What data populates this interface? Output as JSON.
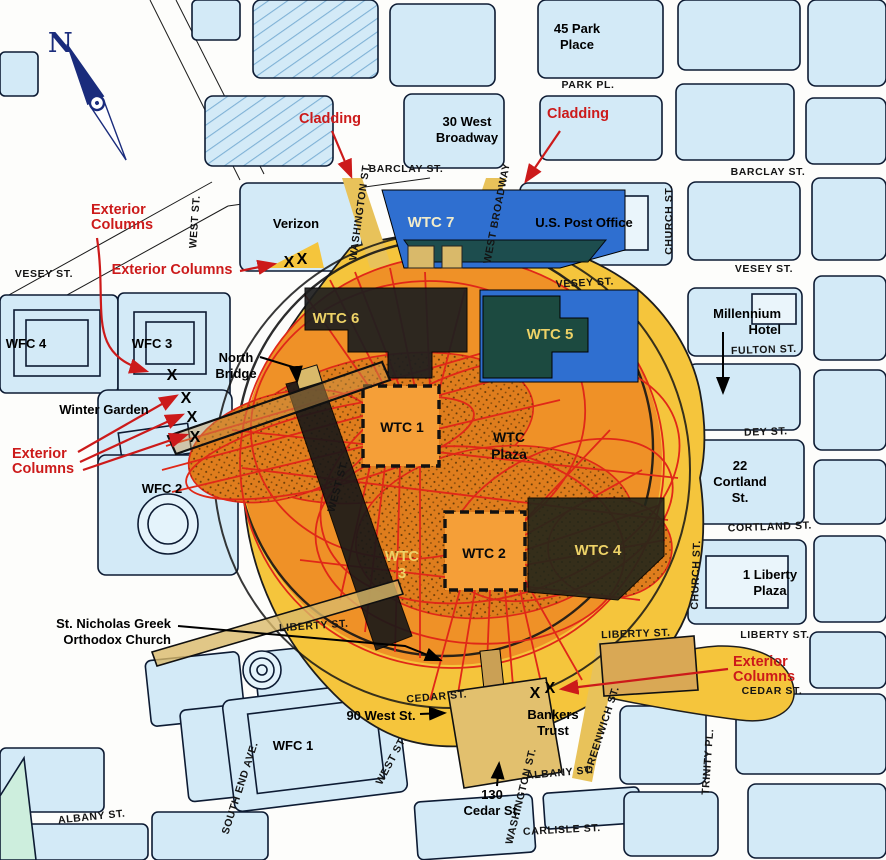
{
  "map": {
    "compass_label": "N",
    "colors": {
      "debris_outer_yellow": "#F5C53C",
      "debris_inner_orange": "#EF9127",
      "debris_dense_orange": "#DF7D1D",
      "impact_line_red": "#E02818",
      "annotation_red": "#CC1A1A",
      "block_fill": "#D3EAF7",
      "block_outline": "#0D1B33",
      "wtc7_blue": "#2F6FD0",
      "wtc5_teal": "#1C4A40",
      "dark_mass": "#1B1B1B",
      "bridge_khaki": "#D9B96A",
      "wtc_label_yellow": "#EDD267",
      "compass_navy": "#1A2C7C"
    },
    "streets": [
      {
        "t": "PARK PL.",
        "x": 588,
        "y": 88,
        "r": 0
      },
      {
        "t": "BARCLAY ST.",
        "x": 406,
        "y": 172,
        "r": 0
      },
      {
        "t": "BARCLAY ST.",
        "x": 768,
        "y": 175,
        "r": 0
      },
      {
        "t": "VESEY ST.",
        "x": 44,
        "y": 277,
        "r": 0
      },
      {
        "t": "VESEY ST.",
        "x": 585,
        "y": 286,
        "r": -3
      },
      {
        "t": "VESEY ST.",
        "x": 764,
        "y": 272,
        "r": 0
      },
      {
        "t": "FULTON ST.",
        "x": 764,
        "y": 353,
        "r": -2
      },
      {
        "t": "DEY ST.",
        "x": 766,
        "y": 435,
        "r": -2
      },
      {
        "t": "CORTLAND ST.",
        "x": 770,
        "y": 530,
        "r": -2
      },
      {
        "t": "LIBERTY ST.",
        "x": 314,
        "y": 629,
        "r": -4
      },
      {
        "t": "LIBERTY ST.",
        "x": 636,
        "y": 637,
        "r": -2
      },
      {
        "t": "LIBERTY ST.",
        "x": 775,
        "y": 638,
        "r": 0
      },
      {
        "t": "CEDAR ST.",
        "x": 437,
        "y": 700,
        "r": -5
      },
      {
        "t": "CEDAR ST.",
        "x": 772,
        "y": 694,
        "r": 0
      },
      {
        "t": "ALBANY ST.",
        "x": 92,
        "y": 820,
        "r": -6
      },
      {
        "t": "ALBANY ST.",
        "x": 560,
        "y": 776,
        "r": -5
      },
      {
        "t": "CARLISLE ST.",
        "x": 562,
        "y": 833,
        "r": -3
      },
      {
        "t": "WEST ST.",
        "x": 198,
        "y": 222,
        "r": -86
      },
      {
        "t": "WEST ST.",
        "x": 341,
        "y": 487,
        "r": -75
      },
      {
        "t": "WEST ST.",
        "x": 394,
        "y": 762,
        "r": -62
      },
      {
        "t": "WASHINGTON ST.",
        "x": 363,
        "y": 212,
        "r": -82
      },
      {
        "t": "WASHINGTON ST.",
        "x": 524,
        "y": 797,
        "r": -76
      },
      {
        "t": "WEST BROADWAY",
        "x": 500,
        "y": 214,
        "r": -79
      },
      {
        "t": "CHURCH ST.",
        "x": 672,
        "y": 220,
        "r": -90
      },
      {
        "t": "CHURCH ST.",
        "x": 699,
        "y": 575,
        "r": -88
      },
      {
        "t": "GREENWICH ST.",
        "x": 605,
        "y": 731,
        "r": -72
      },
      {
        "t": "TRINITY PL.",
        "x": 711,
        "y": 762,
        "r": -86
      },
      {
        "t": "SOUTH END AVE.",
        "x": 243,
        "y": 789,
        "r": -72
      }
    ],
    "buildings": [
      {
        "lines": [
          "45 Park",
          "Place"
        ],
        "x": 577,
        "y": 33,
        "anchor": "middle"
      },
      {
        "lines": [
          "30 West",
          "Broadway"
        ],
        "x": 467,
        "y": 126,
        "anchor": "middle"
      },
      {
        "lines": [
          "Verizon"
        ],
        "x": 296,
        "y": 228,
        "anchor": "middle"
      },
      {
        "lines": [
          "U.S. Post Office"
        ],
        "x": 584,
        "y": 227,
        "anchor": "middle"
      },
      {
        "lines": [
          "Millennium",
          "Hotel"
        ],
        "x": 781,
        "y": 318,
        "anchor": "end"
      },
      {
        "lines": [
          "WFC 4"
        ],
        "x": 26,
        "y": 348,
        "anchor": "middle"
      },
      {
        "lines": [
          "WFC 3"
        ],
        "x": 152,
        "y": 348,
        "anchor": "middle"
      },
      {
        "lines": [
          "North",
          "Bridge"
        ],
        "x": 236,
        "y": 362,
        "anchor": "middle"
      },
      {
        "lines": [
          "Winter Garden"
        ],
        "x": 104,
        "y": 414,
        "anchor": "middle"
      },
      {
        "lines": [
          "WFC 2"
        ],
        "x": 162,
        "y": 493,
        "anchor": "middle"
      },
      {
        "lines": [
          "22",
          "Cortland",
          "St."
        ],
        "x": 740,
        "y": 470,
        "anchor": "middle"
      },
      {
        "lines": [
          "1 Liberty",
          "Plaza"
        ],
        "x": 770,
        "y": 579,
        "anchor": "middle"
      },
      {
        "lines": [
          "St. Nicholas Greek",
          "Orthodox Church"
        ],
        "x": 171,
        "y": 628,
        "anchor": "end"
      },
      {
        "lines": [
          "90 West St."
        ],
        "x": 381,
        "y": 720,
        "anchor": "middle"
      },
      {
        "lines": [
          "Bankers",
          "Trust"
        ],
        "x": 553,
        "y": 719,
        "anchor": "middle"
      },
      {
        "lines": [
          "WFC 1"
        ],
        "x": 293,
        "y": 750,
        "anchor": "middle"
      },
      {
        "lines": [
          "130",
          "Cedar St."
        ],
        "x": 492,
        "y": 799,
        "anchor": "middle"
      }
    ],
    "wtc_labels": [
      {
        "lines": [
          "WTC 7"
        ],
        "x": 431,
        "y": 227,
        "c": "cream"
      },
      {
        "lines": [
          "WTC 6"
        ],
        "x": 336,
        "y": 323,
        "c": "yellow"
      },
      {
        "lines": [
          "WTC 5"
        ],
        "x": 550,
        "y": 339,
        "c": "yellow"
      },
      {
        "lines": [
          "WTC 1"
        ],
        "x": 402,
        "y": 432,
        "c": "black"
      },
      {
        "lines": [
          "WTC",
          "Plaza"
        ],
        "x": 509,
        "y": 442,
        "c": "black"
      },
      {
        "lines": [
          "WTC",
          "3"
        ],
        "x": 402,
        "y": 561,
        "c": "yellow"
      },
      {
        "lines": [
          "WTC 2"
        ],
        "x": 484,
        "y": 558,
        "c": "black"
      },
      {
        "lines": [
          "WTC 4"
        ],
        "x": 598,
        "y": 555,
        "c": "yellow"
      }
    ],
    "red_annotations": [
      {
        "lines": [
          "Cladding"
        ],
        "x": 330,
        "y": 123,
        "anchor": "middle"
      },
      {
        "lines": [
          "Cladding"
        ],
        "x": 578,
        "y": 118,
        "anchor": "middle"
      },
      {
        "lines": [
          "Exterior",
          "Columns"
        ],
        "x": 91,
        "y": 214,
        "anchor": "start"
      },
      {
        "lines": [
          "Exterior Columns"
        ],
        "x": 172,
        "y": 274,
        "anchor": "middle"
      },
      {
        "lines": [
          "Exterior",
          "Columns"
        ],
        "x": 12,
        "y": 458,
        "anchor": "start"
      },
      {
        "lines": [
          "Exterior",
          "Columns"
        ],
        "x": 733,
        "y": 666,
        "anchor": "start"
      }
    ],
    "x_marks": [
      {
        "x": 289,
        "y": 267
      },
      {
        "x": 302,
        "y": 264
      },
      {
        "x": 172,
        "y": 380
      },
      {
        "x": 186,
        "y": 403
      },
      {
        "x": 192,
        "y": 422
      },
      {
        "x": 195,
        "y": 442
      },
      {
        "x": 535,
        "y": 698
      },
      {
        "x": 550,
        "y": 693
      }
    ]
  }
}
